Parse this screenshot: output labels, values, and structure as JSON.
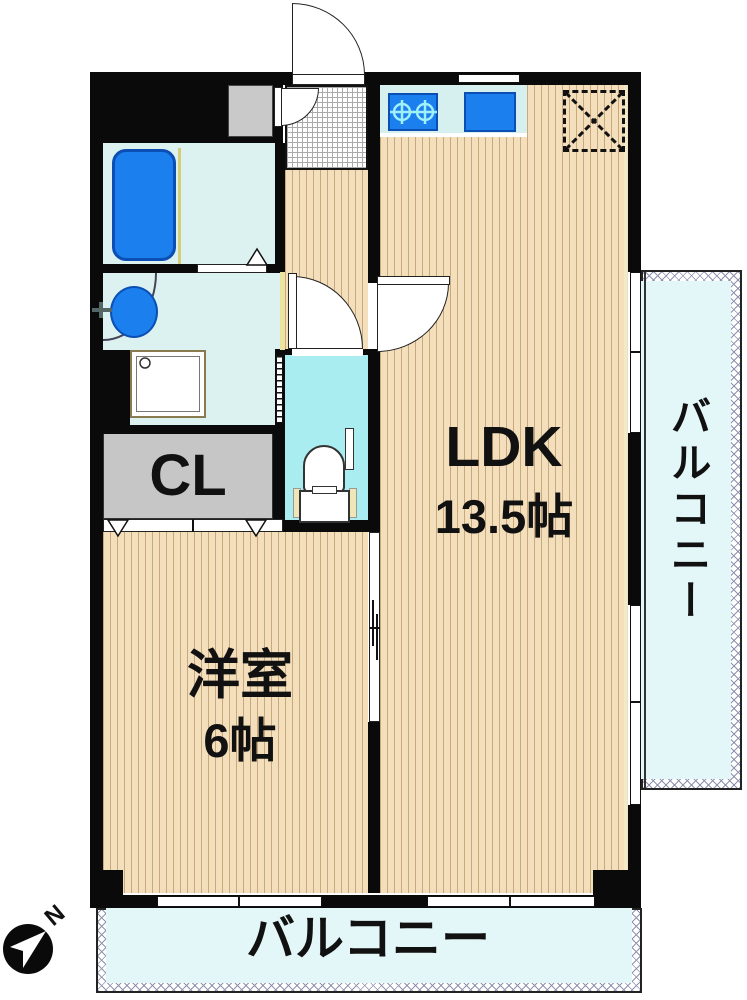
{
  "plan": {
    "rooms": {
      "ldk": {
        "label": "LDK",
        "area": "13.5帖"
      },
      "western": {
        "label": "洋室",
        "area": "6帖"
      },
      "closet": {
        "label": "CL"
      },
      "balcony_right": {
        "label": "バルコニー"
      },
      "balcony_bottom": {
        "label": "バルコニー"
      }
    },
    "compass": {
      "north_label": "N"
    },
    "colors": {
      "wall": "#0a0a0a",
      "flooring": "#F4DFBC",
      "flooring_stripe": "#C9A87C",
      "wet_room": "#DCF2F1",
      "toilet_room": "#A9EDF1",
      "fixture_blue": "#1B7FEE",
      "closet_gray": "#C6C6C6",
      "balcony_fill": "#E3F6F8",
      "accent_yellow": "#EDE3A0"
    }
  }
}
